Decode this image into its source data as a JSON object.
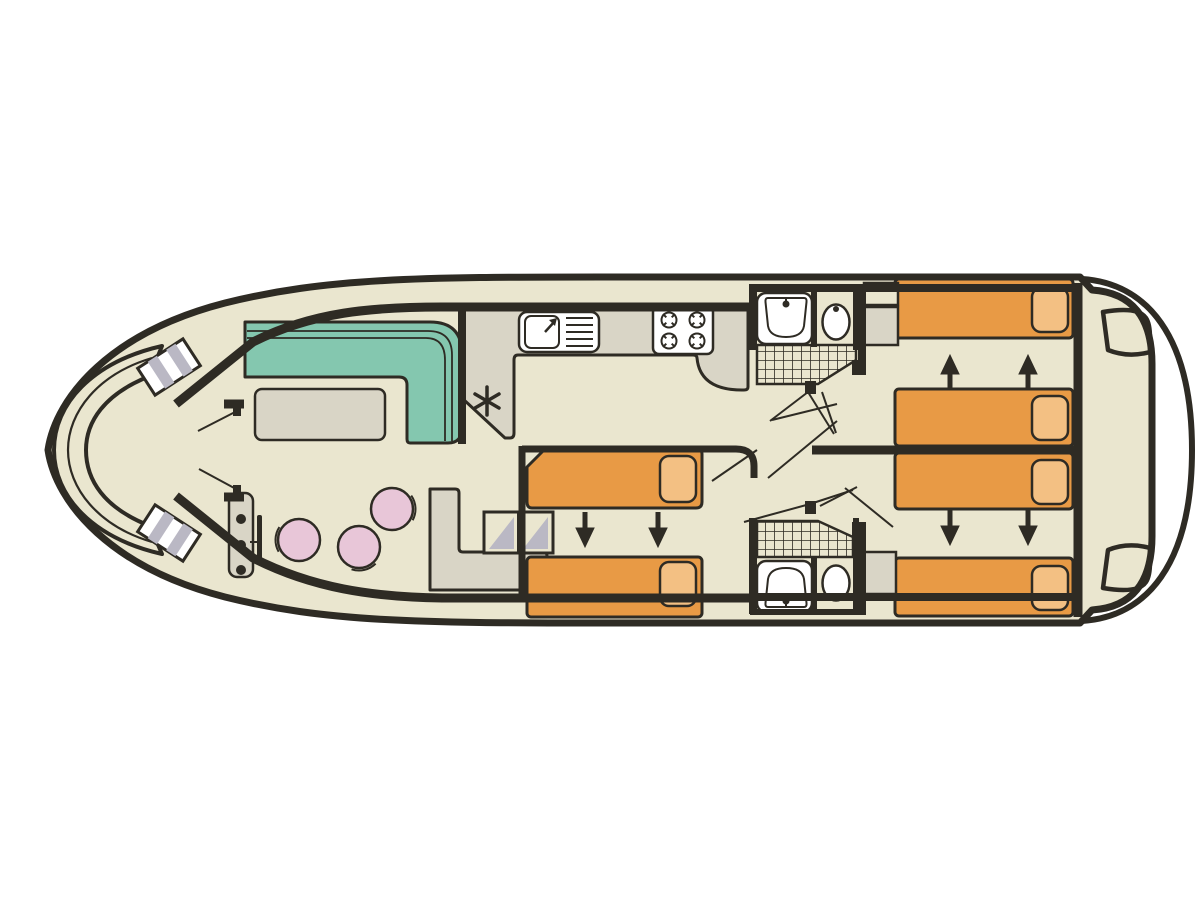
{
  "page": {
    "kind": "boat floor plan diagram",
    "orientation": "bow-left-stern-right"
  },
  "colors": {
    "background": "#ffffff",
    "outline": "#2e2b24",
    "floor": "#eae6cf",
    "furniture-grey": "#d9d5c6",
    "sofa-teal": "#84c7af",
    "bed-orange": "#e89a45",
    "pillow-orange": "#f3c083",
    "stool-pink": "#e8c6d8",
    "step-grey": "#bab8c4",
    "fixture-white": "#ffffff"
  },
  "areas": {
    "bow_deck": {
      "features": [
        "curved-bench",
        "boarding-step-port",
        "boarding-step-starboard",
        "double-entry-doors"
      ]
    },
    "saloon": {
      "features": [
        "l-shaped-sofa",
        "table",
        "stool",
        "stool",
        "stool",
        "helm-console-3-controls",
        "steering-wheel"
      ]
    },
    "galley": {
      "features": [
        "counter",
        "sink-with-drainer",
        "hob-4-burners",
        "star-symbol"
      ]
    },
    "companionway": {
      "features": [
        "steps-2-treads",
        "cabinet"
      ]
    },
    "midship_cabin": {
      "beds": 2,
      "pillows": 2,
      "slide_arrows": "down"
    },
    "forward_bathroom": {
      "features": [
        "washbasin",
        "toilet",
        "shower"
      ]
    },
    "aft_bathroom": {
      "features": [
        "shower",
        "washbasin",
        "toilet"
      ]
    },
    "aft_port_cabin": {
      "beds": 2,
      "pillows": 2,
      "slide_arrows": "up",
      "features": [
        "wardrobe"
      ]
    },
    "aft_starboard_cabin": {
      "beds": 2,
      "pillows": 2,
      "slide_arrows": "down",
      "features": [
        "wardrobe"
      ]
    },
    "stern_deck": {
      "features": [
        "boarding-step",
        "boarding-step",
        "transom-platform"
      ]
    }
  },
  "counts": {
    "beds": 6,
    "bathrooms": 2,
    "stools": 3,
    "hob_burners": 4,
    "slide_arrows": 6
  }
}
